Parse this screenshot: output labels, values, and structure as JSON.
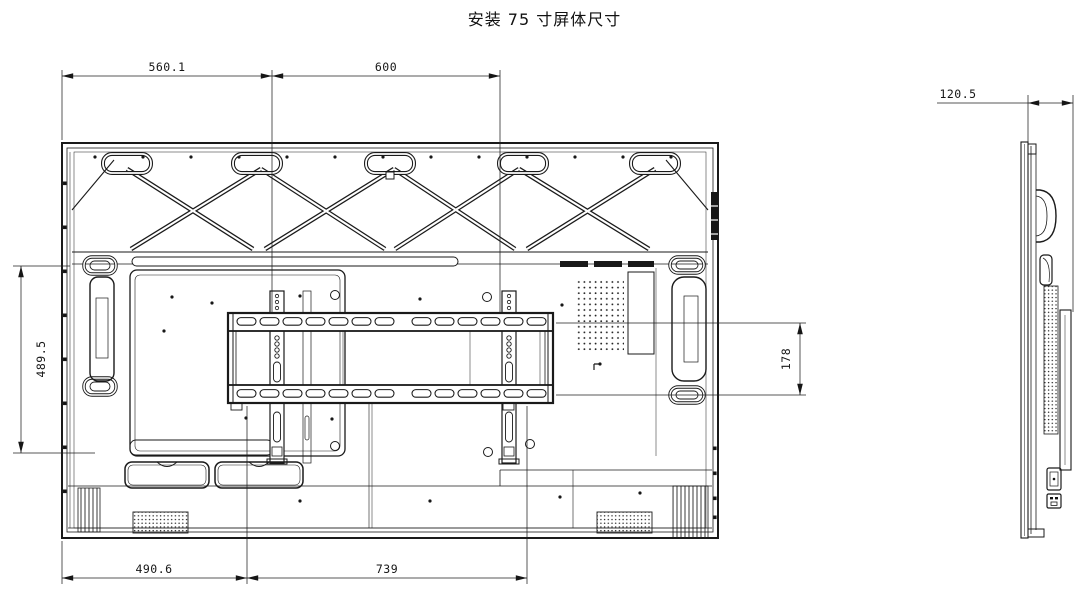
{
  "title": "安装 75 寸屏体尺寸",
  "drawing": {
    "rear_view": {
      "dim_top_left": "560.1",
      "dim_top_right": "600",
      "dim_left_height": "489.5",
      "dim_bracket_height": "178",
      "dim_bottom_left": "490.6",
      "dim_bottom_right": "739"
    },
    "side_view": {
      "dim_depth": "120.5"
    }
  },
  "colors": {
    "line": "#1a1a1a",
    "background": "#ffffff"
  }
}
